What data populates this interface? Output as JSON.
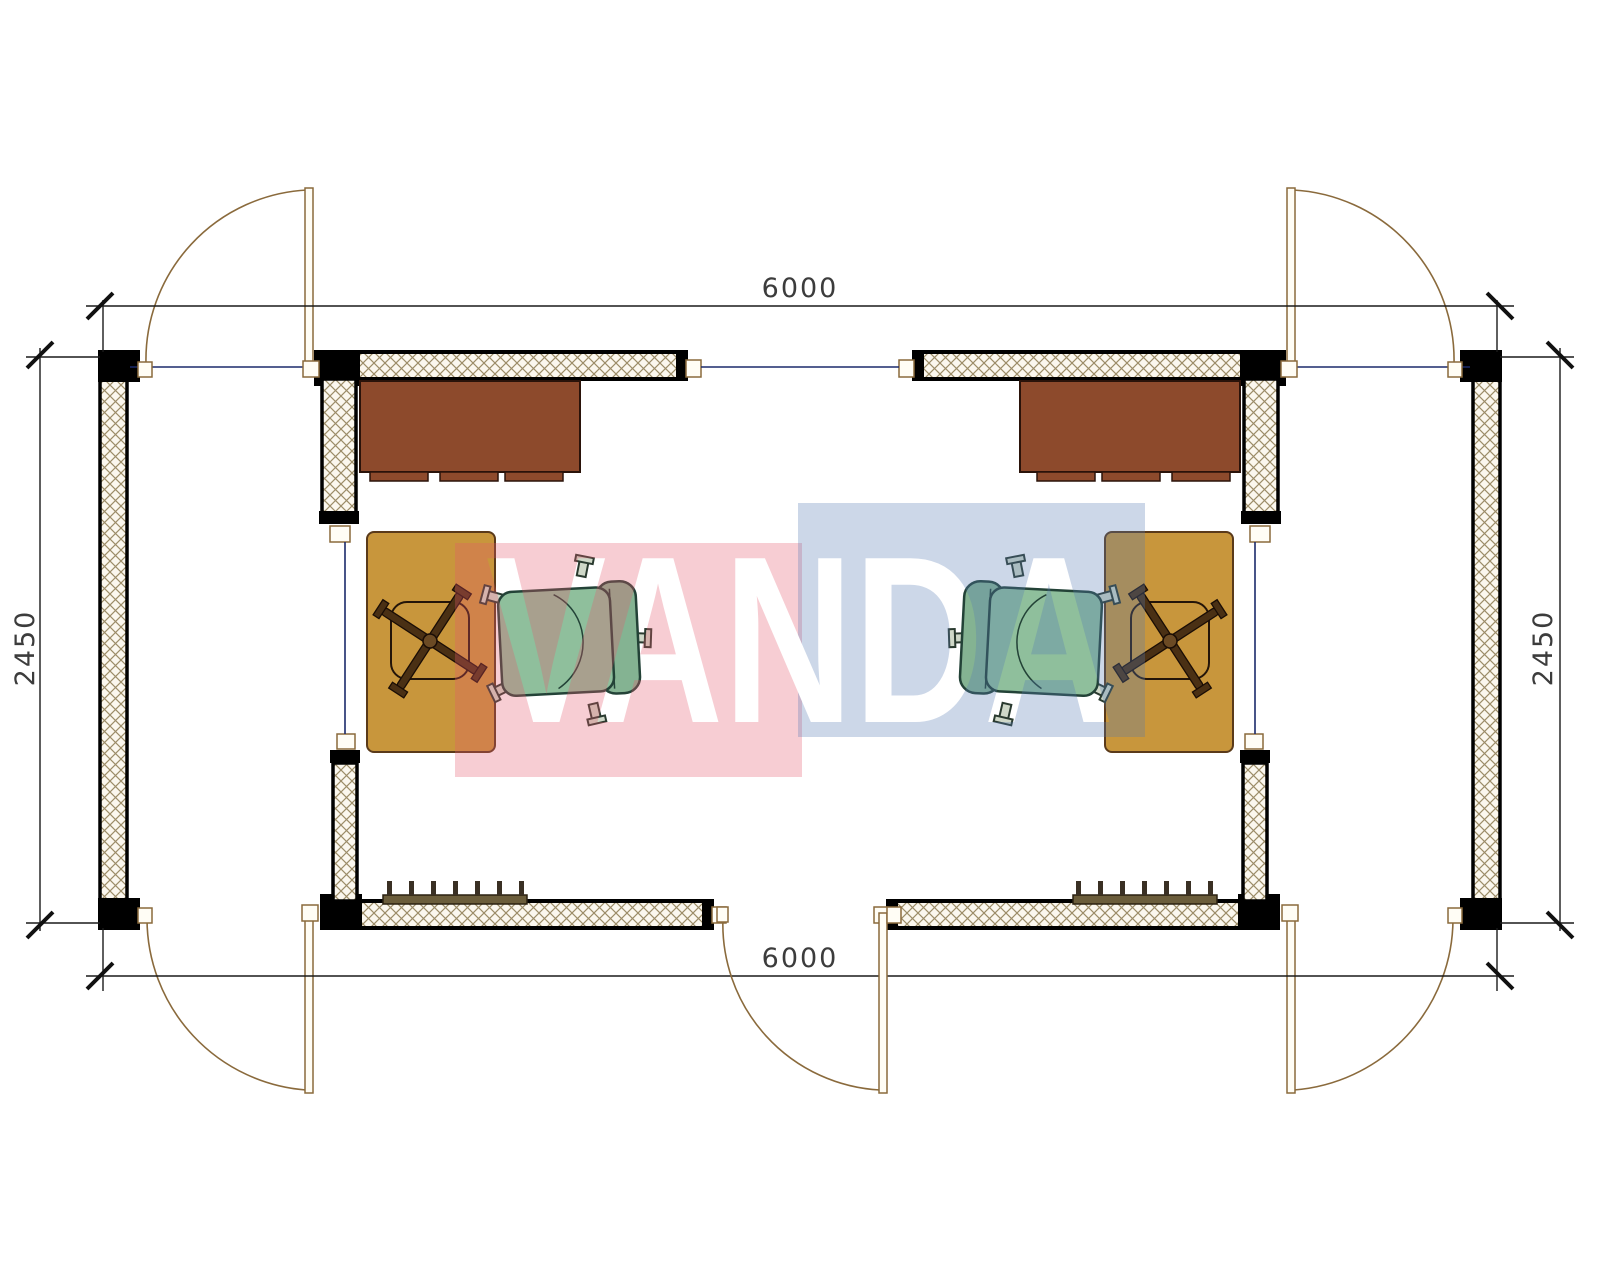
{
  "watermark": {
    "text": "VANDA",
    "pink_overlay": "#ED5A6C",
    "blue_overlay": "#557AB2",
    "overlay_opacity": "0.30"
  },
  "dimensions": {
    "top_width_mm": "6000",
    "bottom_width_mm": "6000",
    "left_height_mm": "2450",
    "right_height_mm": "2450"
  },
  "colors": {
    "wall_outline": "#000000",
    "hatch_line": "#9C8C68",
    "hatch_background": "#FBF7EE",
    "dimension_line": "#1A1A1A",
    "dimension_text": "#3C3C3C",
    "door_line": "#8A6A3C",
    "threshold_line": "#1B2A6B",
    "sideboard_brown": "#8D4A2C",
    "desk_mustard": "#C8963C",
    "chair_green": "#8FBF9C",
    "chair_outline": "#234237",
    "radiator": "#6B5D3B"
  },
  "plan": {
    "type": "floor-plan",
    "description": "Twin modular office plan, mirrored left/right",
    "modules": [
      {
        "id": "left-module",
        "furniture": [
          "brown-sideboard",
          "mustard-work-desk",
          "chair-base-symbol",
          "green-office-chair",
          "radiator"
        ],
        "doors": [
          "top-left-door",
          "bottom-left-door"
        ]
      },
      {
        "id": "right-module",
        "furniture": [
          "brown-sideboard",
          "mustard-work-desk",
          "chair-base-symbol",
          "green-office-chair",
          "radiator"
        ],
        "doors": [
          "top-right-door",
          "bottom-middle-door",
          "bottom-right-door"
        ]
      }
    ]
  }
}
